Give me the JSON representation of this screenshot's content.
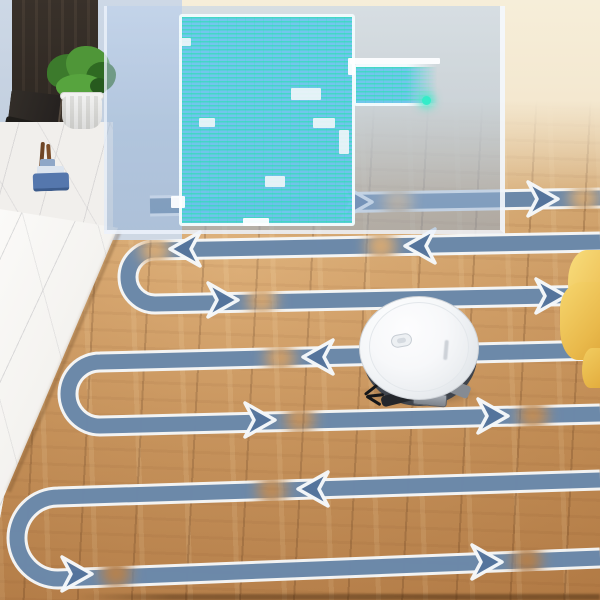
{
  "scene": {
    "subject": "robot-vacuum-cleaning-path-visualization",
    "objects": [
      "wood-floor",
      "robot-vacuum",
      "serpentine-cleaning-path",
      "translucent-map-overlay",
      "marble-counter",
      "dark-tv-cabinet",
      "potted-plant",
      "yellow-blanket-corner"
    ]
  },
  "colors": {
    "stripe": "#5d7da1",
    "stripeDark": "#54749c",
    "outline": "#f6f9fb",
    "mapFill": "rgba(105,196,238,0.92)",
    "mapScan": "#1ee4a8",
    "overlayTint": "rgba(160,188,222,0.52)",
    "woodLight": "#ecd0a0",
    "woodDark": "#b97f46",
    "yellow": "#eec157",
    "marble": "#f2f0ed",
    "robotShell": "#f4f6f8"
  },
  "path": {
    "band_width": 15,
    "outline_width": 21,
    "gap_radius": 15,
    "arrow": {
      "len": 30,
      "half": 17,
      "notch": 21
    },
    "rows": [
      {
        "name": "row-1",
        "d": "M 150 206 L 600 198"
      },
      {
        "name": "row-2-uturn-3",
        "d": "M 600 242 L 155 250 A 27 27 0 0 0 155 304 L 600 295"
      },
      {
        "name": "row-4-uturn-5",
        "d": "M 600 350 L 100 362 A 32 32 0 0 0 100 426 L 600 414"
      },
      {
        "name": "row-6-uturn-7",
        "d": "M 600 480 L 58 497 A 41 41 0 0 0 58 579 L 600 558"
      }
    ],
    "arrows": [
      {
        "x": 372,
        "y": 202,
        "dir": "right"
      },
      {
        "x": 558,
        "y": 199,
        "dir": "right"
      },
      {
        "x": 170,
        "y": 249,
        "dir": "left"
      },
      {
        "x": 405,
        "y": 246,
        "dir": "left"
      },
      {
        "x": 238,
        "y": 300,
        "dir": "right"
      },
      {
        "x": 566,
        "y": 296,
        "dir": "right"
      },
      {
        "x": 303,
        "y": 357,
        "dir": "left"
      },
      {
        "x": 275,
        "y": 420,
        "dir": "right"
      },
      {
        "x": 508,
        "y": 416,
        "dir": "right"
      },
      {
        "x": 298,
        "y": 489,
        "dir": "left"
      },
      {
        "x": 92,
        "y": 574,
        "dir": "right"
      },
      {
        "x": 502,
        "y": 562,
        "dir": "right"
      }
    ],
    "fade_gaps": [
      {
        "x": 398,
        "y": 202
      },
      {
        "x": 584,
        "y": 198
      },
      {
        "x": 155,
        "y": 250
      },
      {
        "x": 381,
        "y": 246
      },
      {
        "x": 262,
        "y": 300
      },
      {
        "x": 280,
        "y": 358
      },
      {
        "x": 300,
        "y": 419
      },
      {
        "x": 533,
        "y": 415
      },
      {
        "x": 272,
        "y": 490
      },
      {
        "x": 116,
        "y": 573
      },
      {
        "x": 527,
        "y": 560
      }
    ]
  },
  "map": {
    "blocks": [
      {
        "x": 72,
        "y": 8,
        "w": 176,
        "h": 212,
        "kind": "room"
      },
      {
        "x": 246,
        "y": 58,
        "w": 86,
        "h": 42,
        "kind": "wing"
      }
    ],
    "walls": [
      {
        "x": 243,
        "y": 52,
        "w": 90,
        "h": 6
      },
      {
        "x": 241,
        "y": 52,
        "w": 7,
        "h": 17
      },
      {
        "x": 64,
        "y": 190,
        "w": 14,
        "h": 12
      },
      {
        "x": 136,
        "y": 212,
        "w": 26,
        "h": 8
      }
    ],
    "notches": [
      {
        "x": 184,
        "y": 82,
        "w": 30,
        "h": 12
      },
      {
        "x": 92,
        "y": 112,
        "w": 16,
        "h": 9
      },
      {
        "x": 206,
        "y": 112,
        "w": 22,
        "h": 10
      },
      {
        "x": 158,
        "y": 170,
        "w": 20,
        "h": 11
      },
      {
        "x": 74,
        "y": 32,
        "w": 10,
        "h": 8
      },
      {
        "x": 232,
        "y": 124,
        "w": 10,
        "h": 24
      }
    ],
    "dot": {
      "x": 315,
      "y": 90
    }
  },
  "robot": {
    "box": {
      "left": 357,
      "top": 296,
      "width": 126,
      "height": 112
    },
    "heading": "left"
  }
}
